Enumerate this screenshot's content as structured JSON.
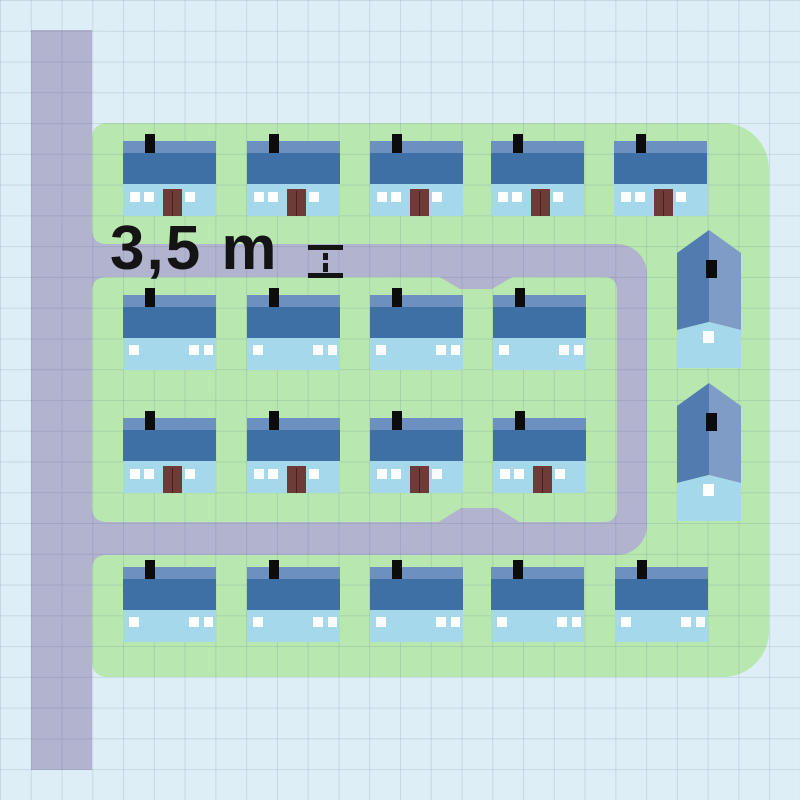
{
  "labels": {
    "road_width": "3,5 m"
  },
  "icons": {
    "measure": "height-ruler-icon"
  },
  "colors": {
    "background": "#deeef6",
    "grid": "rgba(70,100,135,0.16)",
    "road": "#b2b3ce",
    "green": "#b9e7b0",
    "roof_light": "#6c90bf",
    "roof_dark": "#3e70a6",
    "facade": "#a5d8eb",
    "door": "#6e3b38",
    "window": "#ffffff",
    "chimney": "#0c0c0c",
    "gable_left": "#527cb0",
    "gable_right": "#7e9cc6",
    "label": "#141414"
  },
  "map": {
    "grid_cell_px": 30.77,
    "houses_total": 19,
    "house_rows": [
      {
        "type": "front",
        "y": 141,
        "xs": [
          123,
          247,
          370,
          491,
          614
        ]
      },
      {
        "type": "back",
        "y": 295,
        "xs": [
          123,
          247,
          370,
          493
        ]
      },
      {
        "type": "front",
        "y": 418,
        "xs": [
          123,
          247,
          370,
          493
        ]
      },
      {
        "type": "back",
        "y": 567,
        "xs": [
          123,
          247,
          370,
          491,
          615
        ]
      }
    ],
    "gable_houses": {
      "x": 677,
      "ys": [
        230,
        383
      ]
    }
  }
}
